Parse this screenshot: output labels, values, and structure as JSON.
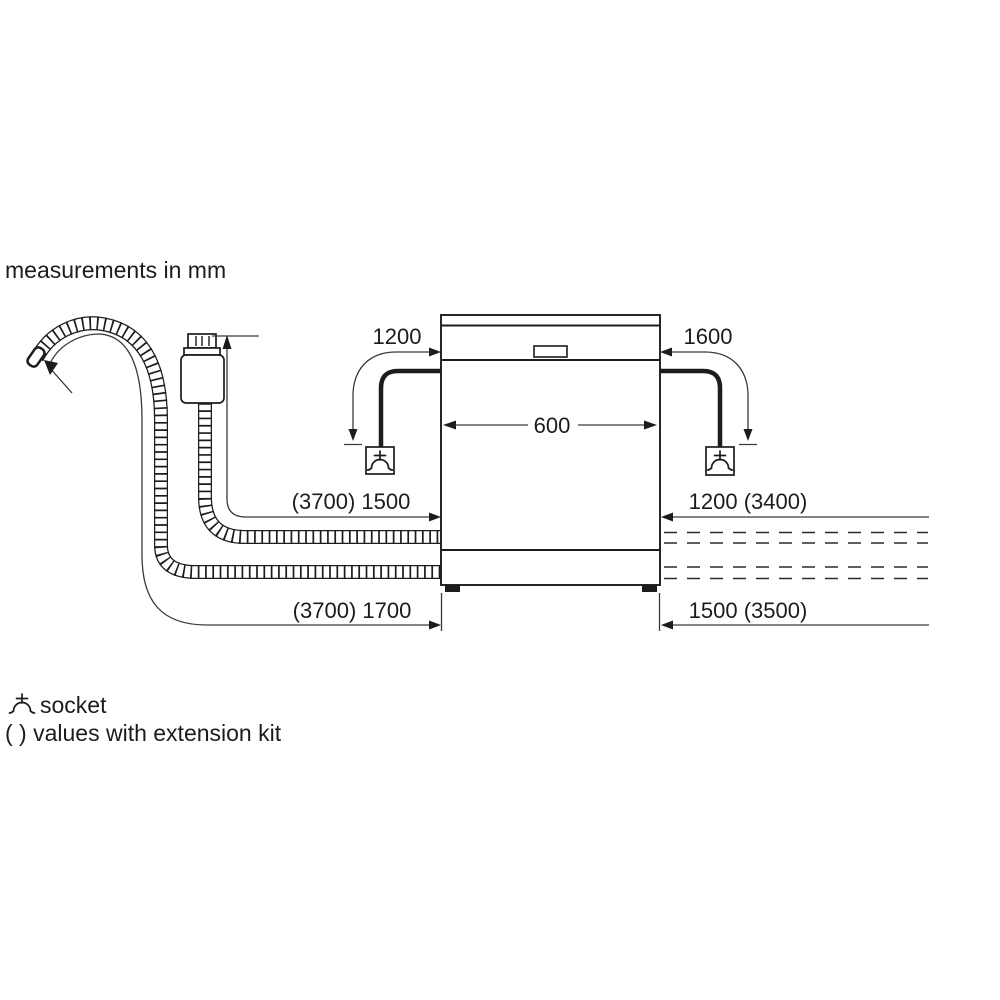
{
  "title": "measurements in mm",
  "dimensions": {
    "cord_to_socket_left": "1200",
    "cord_to_socket_right": "1600",
    "appliance_width": "600",
    "hose_left_upper": "(3700) 1500",
    "hose_left_lower": "(3700) 1700",
    "hose_right_upper": "1200 (3400)",
    "hose_right_lower": "1500 (3500)"
  },
  "legend": {
    "socket_label": "socket",
    "extension_note": "( ) values with extension kit"
  },
  "icons": {
    "socket_symbol": "socket-icon"
  },
  "colors": {
    "ink": "#1c1c1c",
    "background": "#ffffff"
  }
}
